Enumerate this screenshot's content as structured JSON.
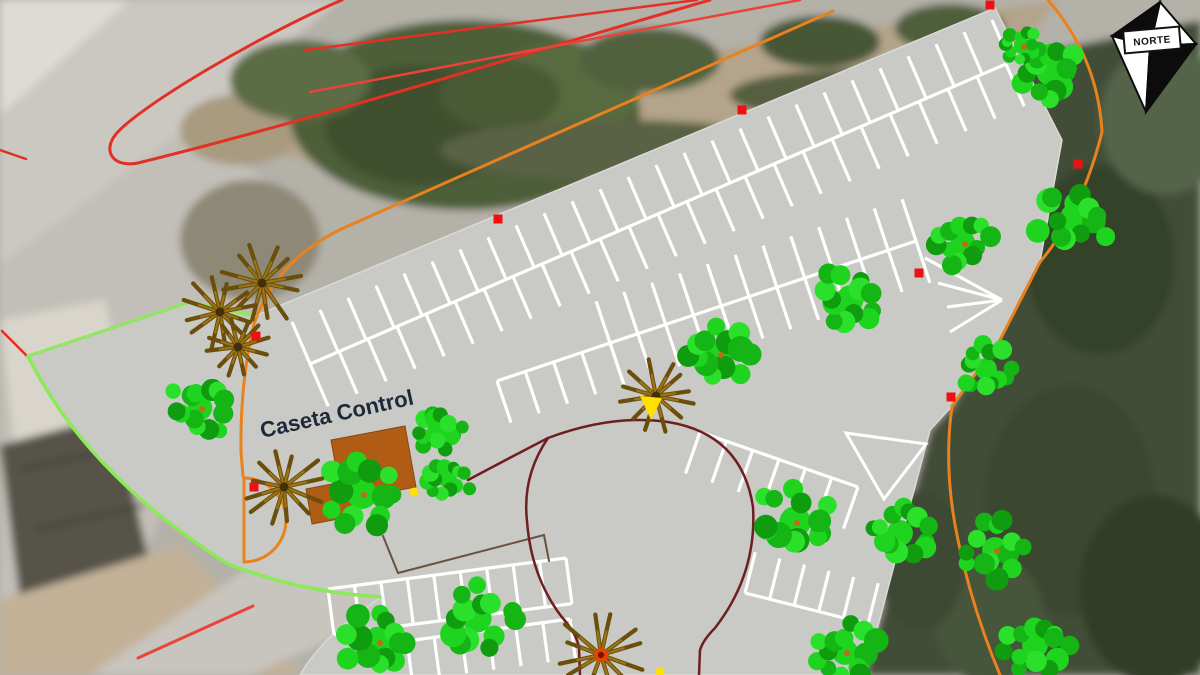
{
  "map": {
    "labels": {
      "control_booth": "Caseta Control",
      "compass": "NORTE"
    },
    "palette": {
      "lot_fill": "#c9c9c6",
      "lot_edge": "#d9d9d6",
      "stripe": "#ffffff",
      "road_red": "#e23025",
      "road_red_light": "#e8443a",
      "boundary_orange": "#e8821e",
      "boundary_lime": "#8bea55",
      "circle_maroon": "#6e1f1f",
      "terrace_brown": "#6a5142",
      "tree_greens": [
        "#14b514",
        "#1fd41f",
        "#0f9c0f",
        "#2ae02a"
      ],
      "tree_speck": "#c06a1a",
      "palm_arm_dark": "#6b4e0c",
      "palm_arm_light": "#9a7518",
      "palm_center": "#41300a",
      "palm_center_hot": "#e84300",
      "building_brown": "#b05c14",
      "marker_red": "#ee1111",
      "marker_yellow": "#ffe000"
    },
    "lot_outline": "M28,356 L190,302 L255,316 L995,8 L1062,140 L1040,262 L1000,340 L952,406 L930,430 L865,675 L300,675 Q322,636 380,598 Q300,592 228,564 Q86,474 28,356 Z",
    "building_paths": [
      "M331,440 L405,426 L416,487 L342,501 Z",
      "M306,489 L348,481 L354,516 L312,524 Z"
    ],
    "island_triangle": "M846,433 L926,444 L884,499 Z",
    "parking_rows": [
      {
        "p1": [
          292,
          322
        ],
        "p2": [
          992,
          20
        ],
        "n": [
          0.396,
          0.918
        ],
        "depth": 46,
        "stripes": 26,
        "base": false,
        "cap": false
      },
      {
        "p1": [
          310,
          364
        ],
        "p2": [
          1006,
          64
        ],
        "n": [
          0.396,
          0.918
        ],
        "depth": 46,
        "stripes": 25,
        "base": true,
        "cap": false
      },
      {
        "p1": [
          610,
          343
        ],
        "p2": [
          916,
          241
        ],
        "n": [
          -0.316,
          -0.949
        ],
        "depth": 44,
        "stripes": 12,
        "base": true,
        "cap": false
      },
      {
        "p1": [
          610,
          343
        ],
        "p2": [
          916,
          241
        ],
        "n": [
          0.316,
          0.949
        ],
        "depth": 44,
        "stripes": 12,
        "base": false,
        "cap": false
      },
      {
        "p1": [
          497,
          381
        ],
        "p2": [
          610,
          343
        ],
        "n": [
          0.319,
          0.948
        ],
        "depth": 44,
        "stripes": 5,
        "base": true,
        "cap": false
      },
      {
        "p1": [
          700,
          432
        ],
        "p2": [
          858,
          487
        ],
        "n": [
          -0.329,
          0.944
        ],
        "depth": 44,
        "stripes": 7,
        "base": true,
        "cap": false
      },
      {
        "p1": [
          745,
          593
        ],
        "p2": [
          868,
          624
        ],
        "n": [
          0.244,
          -0.97
        ],
        "depth": 42,
        "stripes": 6,
        "base": true,
        "cap": false
      },
      {
        "p1": [
          328,
          589
        ],
        "p2": [
          566,
          558
        ],
        "n": [
          0.129,
          0.992
        ],
        "depth": 46,
        "stripes": 10,
        "base": true,
        "cap": true
      },
      {
        "p1": [
          407,
          641
        ],
        "p2": [
          570,
          619
        ],
        "n": [
          0.134,
          0.991
        ],
        "depth": 40,
        "stripes": 7,
        "base": true,
        "cap": false
      }
    ],
    "fan_lines": "M1002,300 L925,258 M1002,300 L938,283 M1002,300 L947,307 M1002,300 L950,332",
    "lines": [
      {
        "name": "red-hairpin",
        "color": "#e23025",
        "width": 3,
        "d": "M342,0 C258,36 140,106 116,134 C102,151 113,168 138,163 C320,118 530,52 710,0"
      },
      {
        "name": "red-upper-a",
        "color": "#e23025",
        "width": 2.5,
        "d": "M305,50 L697,0"
      },
      {
        "name": "red-upper-b",
        "color": "#e8443a",
        "width": 2.5,
        "d": "M310,92 L800,0"
      },
      {
        "name": "red-left-small",
        "color": "#e23025",
        "width": 2.5,
        "d": "M0,150 L26,159"
      },
      {
        "name": "red-lime-cross",
        "color": "#e23025",
        "width": 2.5,
        "d": "M2,331 L30,359"
      },
      {
        "name": "red-bottom",
        "color": "#e8443a",
        "width": 3,
        "d": "M138,658 L253,606"
      },
      {
        "name": "orange-west",
        "color": "#e8821e",
        "width": 3,
        "d": "M833,11 L348,226 Q276,258 254,324 Q240,382 241,452 L243,476"
      },
      {
        "name": "orange-gate",
        "color": "#e8821e",
        "width": 3,
        "d": "M244,478 A42,42 0 0 1 286,520 M244,562 A42,42 0 0 0 286,520 M244,478 L244,562"
      },
      {
        "name": "orange-east",
        "color": "#e8821e",
        "width": 3,
        "d": "M1048,0 Q1098,58 1102,132 Q1082,212 1040,262 L1000,340 L952,406 Q943,470 958,540 Q972,608 1000,675"
      },
      {
        "name": "lime-edge",
        "color": "#8bea55",
        "width": 3,
        "d": "M28,356 L190,302 L255,316"
      },
      {
        "name": "lime-curve",
        "color": "#8bea55",
        "width": 3.5,
        "d": "M28,356 Q86,474 228,564 Q300,592 380,597"
      },
      {
        "name": "terrace-line",
        "color": "#6a5142",
        "width": 2,
        "d": "M383,536 L398,573 L544,535 L549,561"
      },
      {
        "name": "maroon-circle",
        "color": "#6e1f1f",
        "width": 2.5,
        "d": "M468,480 Q515,455 548,438 Q612,414 668,422 Q742,434 753,507 Q757,574 715,628 Q703,640 700,650 L699,675"
      },
      {
        "name": "maroon-circle-left",
        "color": "#6e1f1f",
        "width": 2.5,
        "d": "M548,438 Q522,476 527,521 Q531,576 561,616 Q577,634 579,648 L580,675"
      }
    ],
    "trees": [
      [
        1050,
        72,
        40
      ],
      [
        1022,
        46,
        24
      ],
      [
        1075,
        218,
        44
      ],
      [
        963,
        243,
        36
      ],
      [
        850,
        299,
        40
      ],
      [
        719,
        354,
        42
      ],
      [
        986,
        369,
        32
      ],
      [
        200,
        408,
        36
      ],
      [
        438,
        430,
        31
      ],
      [
        362,
        494,
        44
      ],
      [
        447,
        478,
        28
      ],
      [
        378,
        642,
        45
      ],
      [
        477,
        618,
        43
      ],
      [
        795,
        522,
        46
      ],
      [
        900,
        533,
        38
      ],
      [
        995,
        550,
        38
      ],
      [
        1035,
        645,
        38
      ],
      [
        845,
        652,
        38
      ]
    ],
    "palms": [
      {
        "x": 262,
        "y": 283,
        "r": 48,
        "hot": false
      },
      {
        "x": 220,
        "y": 312,
        "r": 40,
        "hot": false
      },
      {
        "x": 238,
        "y": 347,
        "r": 36,
        "hot": false
      },
      {
        "x": 284,
        "y": 487,
        "r": 42,
        "hot": false
      },
      {
        "x": 656,
        "y": 396,
        "r": 44,
        "hot": false
      },
      {
        "x": 601,
        "y": 655,
        "r": 46,
        "hot": true
      }
    ],
    "red_markers": [
      [
        990,
        5
      ],
      [
        742,
        110
      ],
      [
        498,
        219
      ],
      [
        1078,
        164
      ],
      [
        919,
        273
      ],
      [
        951,
        397
      ],
      [
        256,
        336
      ],
      [
        254,
        487
      ]
    ],
    "yellow_dots": [
      [
        414,
        492
      ],
      [
        660,
        672
      ]
    ],
    "yellow_triangle": "M640,396 L662,398 L651,420 Z",
    "compass": {
      "kite": {
        "top": [
          1160,
          2
        ],
        "left": [
          1112,
          36
        ],
        "right": [
          1196,
          44
        ],
        "bottom": [
          1146,
          112
        ],
        "center": [
          1150,
          46
        ]
      },
      "box": [
        1124,
        29,
        56,
        22
      ]
    }
  }
}
